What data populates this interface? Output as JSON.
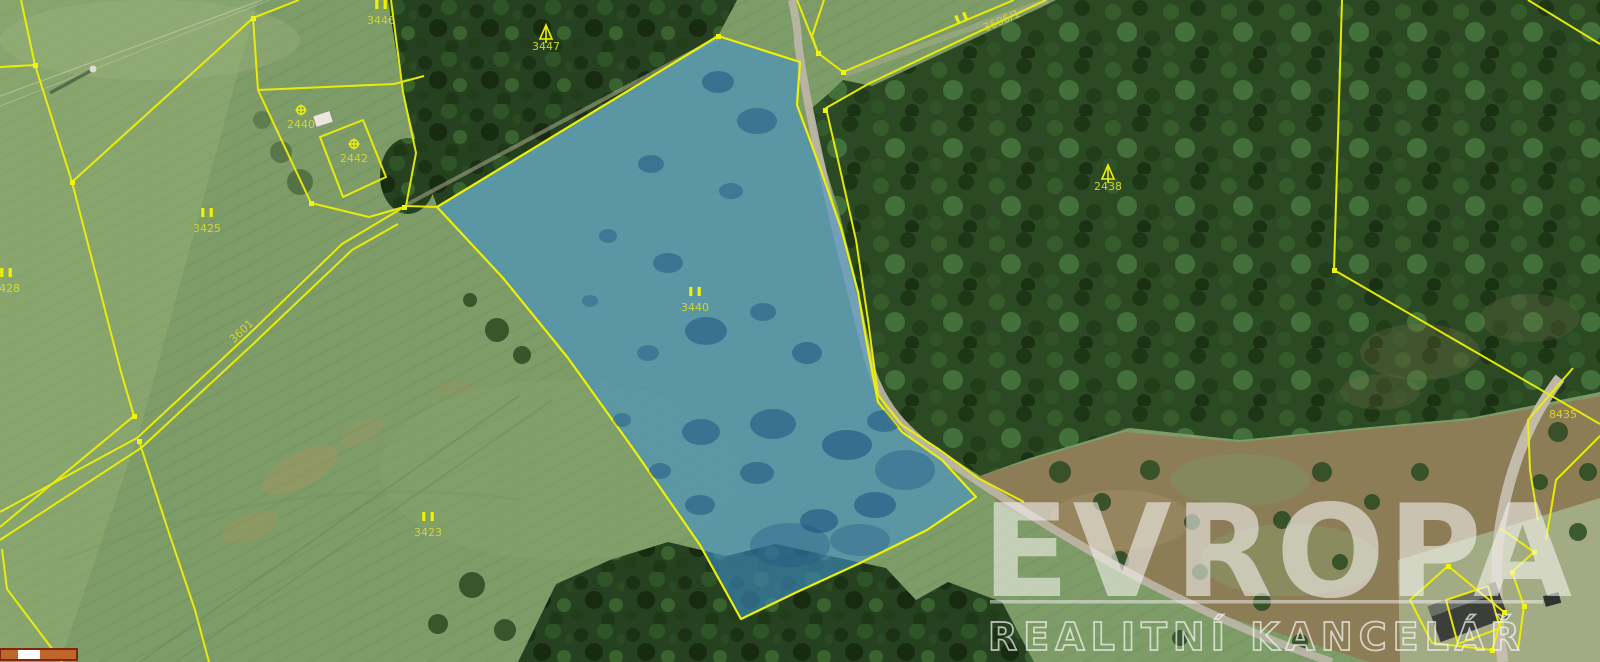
{
  "map": {
    "type": "cadastral-aerial-imagery",
    "highlighted_parcel": {
      "symbol": "II",
      "number": "3440"
    },
    "colors": {
      "boundary_yellow": "#eef005",
      "label_olive": "#d6d832",
      "highlight_blue": "#3f93cf",
      "scale_fill": "#c1662b",
      "scale_outline": "#7c2810",
      "watermark_white": "#f4f4f2"
    },
    "parcel_labels": [
      {
        "symbol": "II",
        "number": "3446",
        "x": 381,
        "y": 24,
        "rot": 0
      },
      {
        "symbol": "conifer",
        "number": "3447",
        "x": 546,
        "y": 50,
        "rot": 0
      },
      {
        "symbol": "circle-cross",
        "number": "2440",
        "x": 301,
        "y": 128,
        "rot": 0
      },
      {
        "symbol": "circle-cross",
        "number": "2442",
        "x": 354,
        "y": 162,
        "rot": 0
      },
      {
        "symbol": "II",
        "number": "3425",
        "x": 207,
        "y": 232,
        "rot": 0
      },
      {
        "symbol": "II",
        "number": "3428",
        "x": 6,
        "y": 292,
        "rot": 0
      },
      {
        "symbol": "",
        "number": "3601",
        "x": 244,
        "y": 334,
        "rot": -43
      },
      {
        "symbol": "II",
        "number": "",
        "x": 969,
        "y": 36,
        "rot": -23
      },
      {
        "symbol": "",
        "number": "3606/1",
        "x": 1003,
        "y": 24,
        "rot": -23
      },
      {
        "symbol": "II",
        "number": "3440",
        "x": 695,
        "y": 311,
        "rot": 0
      },
      {
        "symbol": "II",
        "number": "3423",
        "x": 428,
        "y": 536,
        "rot": 0
      },
      {
        "symbol": "conifer",
        "number": "2438",
        "x": 1108,
        "y": 190,
        "rot": 0
      },
      {
        "symbol": "",
        "number": "8435",
        "x": 1563,
        "y": 418,
        "rot": 0
      }
    ],
    "watermark": {
      "brand": "EVROPA",
      "subtitle": "REALITNÍ KANCELÁŘ"
    }
  }
}
